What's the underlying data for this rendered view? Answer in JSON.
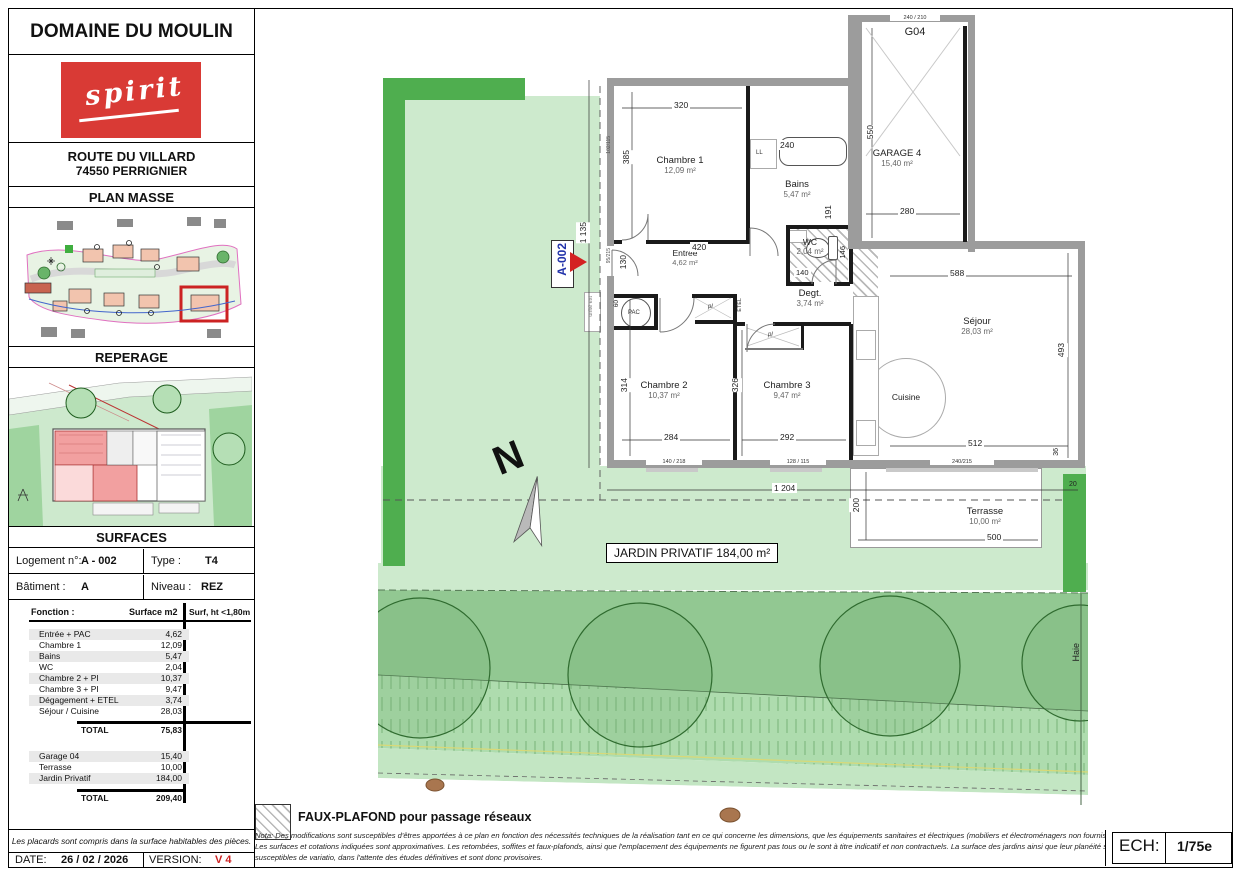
{
  "sidebar": {
    "title": "DOMAINE DU MOULIN",
    "logo_text": "spirit",
    "address_line1": "ROUTE DU VILLARD",
    "address_line2": "74550 PERRIGNIER",
    "section_plan_masse": "PLAN MASSE",
    "section_reperage": "REPERAGE",
    "section_surfaces": "SURFACES",
    "info": {
      "logement_label": "Logement n°:",
      "logement_value": "A - 002",
      "type_label": "Type :",
      "type_value": "T4",
      "batiment_label": "Bâtiment :",
      "batiment_value": "A",
      "niveau_label": "Niveau :",
      "niveau_value": "REZ"
    },
    "table": {
      "col_fonction": "Fonction :",
      "col_surface": "Surface m2",
      "col_surf_ht": "Surf, ht <1,80m",
      "rows": [
        {
          "label": "Entrée + PAC",
          "value": "4,62"
        },
        {
          "label": "Chambre 1",
          "value": "12,09"
        },
        {
          "label": "Bains",
          "value": "5,47"
        },
        {
          "label": "WC",
          "value": "2,04"
        },
        {
          "label": "Chambre 2 + PI",
          "value": "10,37"
        },
        {
          "label": "Chambre 3 + PI",
          "value": "9,47"
        },
        {
          "label": "Dégagement + ETEL",
          "value": "3,74"
        },
        {
          "label": "Séjour / Cuisine",
          "value": "28,03"
        }
      ],
      "total1_label": "TOTAL",
      "total1_value": "75,83",
      "rows2": [
        {
          "label": "Garage 04",
          "value": "15,40"
        },
        {
          "label": "Terrasse",
          "value": "10,00"
        },
        {
          "label": "Jardin Privatif",
          "value": "184,00"
        }
      ],
      "total2_label": "TOTAL",
      "total2_value": "209,40"
    },
    "footnote": "Les placards sont compris dans la surface habitables des pièces.",
    "date_label": "DATE:",
    "date_value": "26 / 02 / 2026",
    "version_label": "VERSION:",
    "version_value": "V 4"
  },
  "plan": {
    "unit_label": "A-002",
    "north_letter": "N",
    "jardin_label": "JARDIN PRIVATIF 184,00 m²",
    "haie_label": "Haie",
    "rooms": {
      "chambre1": {
        "name": "Chambre 1",
        "area": "12,09 m²"
      },
      "bains": {
        "name": "Bains",
        "area": "5,47 m²"
      },
      "wc": {
        "name": "WC",
        "area": "2,04 m²"
      },
      "garage": {
        "code": "G04",
        "name": "GARAGE 4",
        "area": "15,40 m²"
      },
      "entree": {
        "name": "Entrée",
        "area": "4,62 m²"
      },
      "degt": {
        "name": "Degt.",
        "area": "3,74 m²"
      },
      "chambre2": {
        "name": "Chambre 2",
        "area": "10,37 m²"
      },
      "chambre3": {
        "name": "Chambre 3",
        "area": "9,47 m²"
      },
      "sejour": {
        "name": "Séjour",
        "area": "28,03 m²"
      },
      "cuisine": {
        "name": "Cuisine"
      },
      "terrasse": {
        "name": "Terrasse",
        "area": "10,00 m²"
      }
    },
    "small_labels": {
      "pac": "PAC",
      "ll": "LL",
      "pl": "pl",
      "etel": "ETEL",
      "unite_ext": "unité ext"
    },
    "dims": {
      "d320": "320",
      "d385": "385",
      "d240": "240",
      "d191": "191",
      "d550": "550",
      "d280": "280",
      "d420": "420",
      "d130": "130",
      "d140": "140",
      "d146": "146",
      "d60": "60",
      "d314": "314",
      "d284": "284",
      "d326": "326",
      "d292": "292",
      "d588": "588",
      "d493": "493",
      "d512": "512",
      "d200": "200",
      "d500": "500",
      "d1135": "1 135",
      "d1204": "1 204",
      "d20": "20",
      "d36": "36"
    },
    "openings": {
      "garage_door": "240 / 210",
      "win_chambre1": "102/115",
      "door_entree": "95/215",
      "win_chambre2": "140 / 218",
      "win_chambre3": "128 / 115",
      "win_sejour": "240/215"
    }
  },
  "footer": {
    "legend_text": "FAUX-PLAFOND pour passage réseaux",
    "nota_line1": "Nota: Des modifications sont susceptibles d'êtres apportées à ce plan en fonction des nécessités techniques de la réalisation tant en ce qui concerne les dimensions, que les équipements sanitaires et électriques (mobiliers et électroménagers non fournis).",
    "nota_line2": "Les surfaces et cotations indiquées sont approximatives. Les retombées, soffites et faux-plafonds, ainsi que l'emplacement des équipements ne figurent pas tous ou le sont à titre indicatif et non contractuels. La surface des jardins ainsi que leur planéité sont",
    "nota_line3": "susceptibles de variatio, dans l'attente des études définitives et sont donc provisoires.",
    "ech_label": "ECH:",
    "ech_value": "1/75e"
  }
}
